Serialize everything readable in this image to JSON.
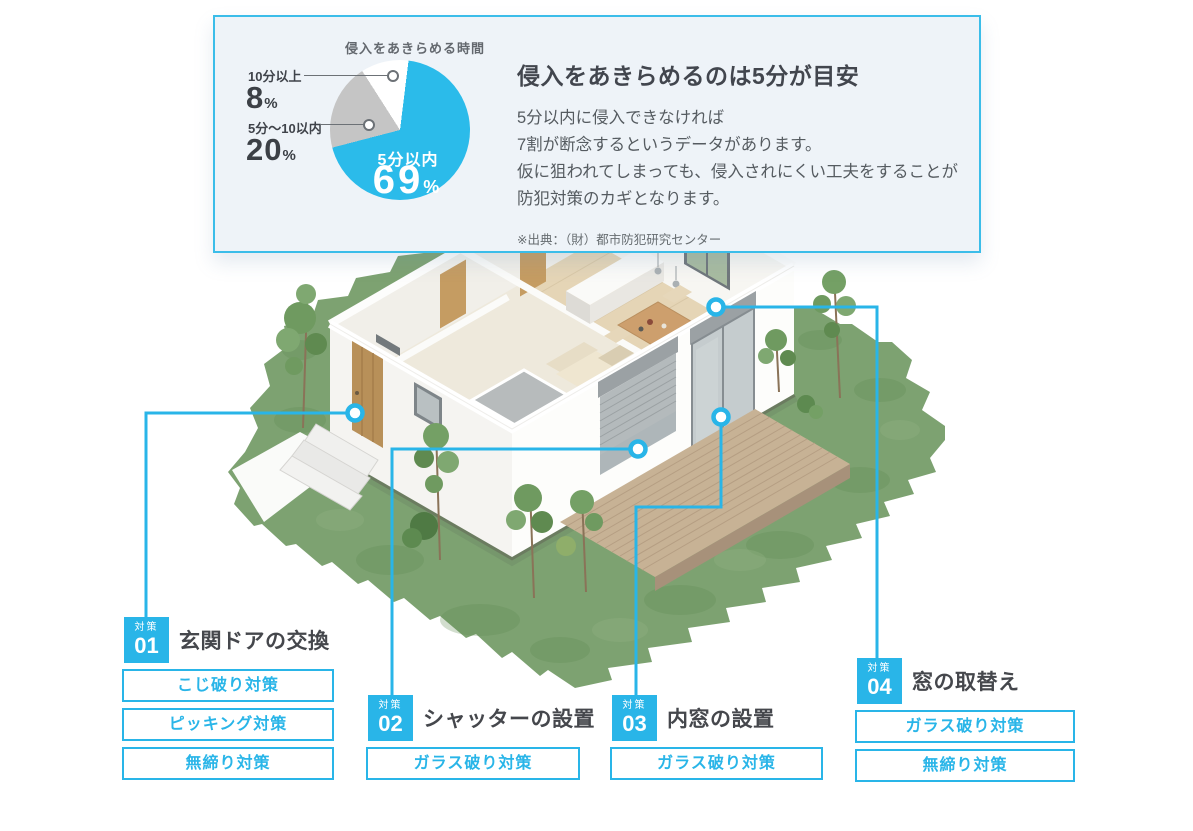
{
  "colors": {
    "accent": "#29b5e8",
    "card_bg": "#eef3f8",
    "card_border": "#3bbde9",
    "pie_blue": "#2bbbea",
    "pie_gray": "#c5c5c5",
    "heading_text": "#42464e",
    "body_text": "#555b60"
  },
  "chart_data": {
    "type": "pie",
    "title": "侵入をあきらめる時間",
    "unit": "%",
    "start_angle_deg": 7,
    "direction": "clockwise",
    "legend": false,
    "slices": [
      {
        "label": "5分以内",
        "value": 69,
        "color": "#2bbbea",
        "label_placement": "inside"
      },
      {
        "label": "5分〜10以内",
        "value": 20,
        "color": "#c5c5c5",
        "label_placement": "outside-left"
      },
      {
        "label": "10分以上",
        "value": 8,
        "color": "#ffffff",
        "label_placement": "outside-left"
      }
    ]
  },
  "info_card": {
    "heading": "侵入をあきらめるのは5分が目安",
    "body_lines": [
      "5分以内に侵入できなければ",
      "7割が断念するというデータがあります。",
      "仮に狙われてしまっても、侵入されにくい工夫をすることが",
      "防犯対策のカギとなります。"
    ],
    "source": "※出典：（財）都市防犯研究センター"
  },
  "measures": {
    "groups": [
      {
        "tag": "対策",
        "number": "01",
        "title": "玄関ドアの交換",
        "items": [
          "こじ破り対策",
          "ピッキング対策",
          "無締り対策"
        ]
      },
      {
        "tag": "対策",
        "number": "02",
        "title": "シャッターの設置",
        "items": [
          "ガラス破り対策"
        ]
      },
      {
        "tag": "対策",
        "number": "03",
        "title": "内窓の設置",
        "items": [
          "ガラス破り対策"
        ]
      },
      {
        "tag": "対策",
        "number": "04",
        "title": "窓の取替え",
        "items": [
          "ガラス破り対策",
          "無締り対策"
        ]
      }
    ]
  }
}
